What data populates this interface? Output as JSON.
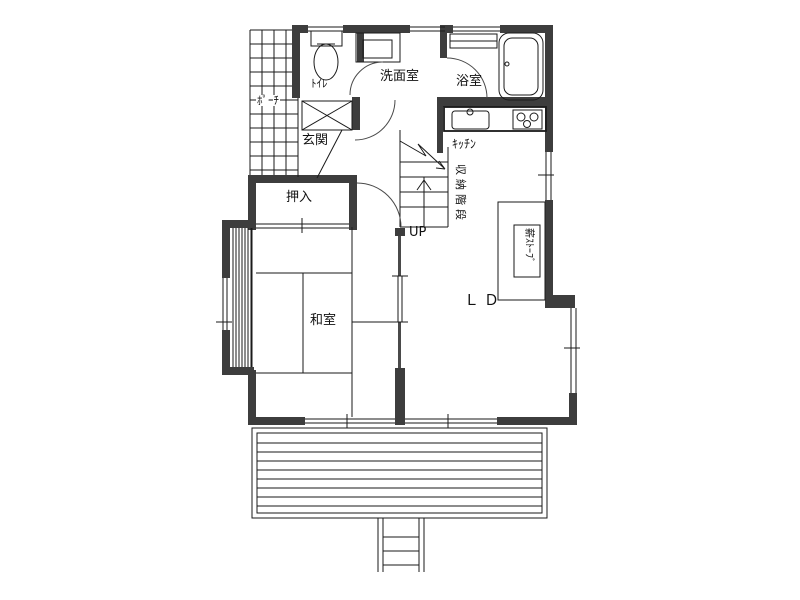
{
  "labels": {
    "porch": "ﾎﾟｰﾁ",
    "toilet": "ﾄｲﾚ",
    "washroom": "洗面室",
    "bathroom": "浴室",
    "entrance": "玄関",
    "closet": "押入",
    "japanese_room": "和室",
    "kitchen": "ｷｯﾁﾝ",
    "living_dining": "ＬＤ",
    "stairs_up": "UP",
    "storage_stairs": "収納階段",
    "wood_stove": "薪ｽﾄｰﾌﾞ"
  },
  "colors": {
    "wall": "#3d3d3d",
    "line": "#1a1a1a",
    "background": "#ffffff"
  }
}
